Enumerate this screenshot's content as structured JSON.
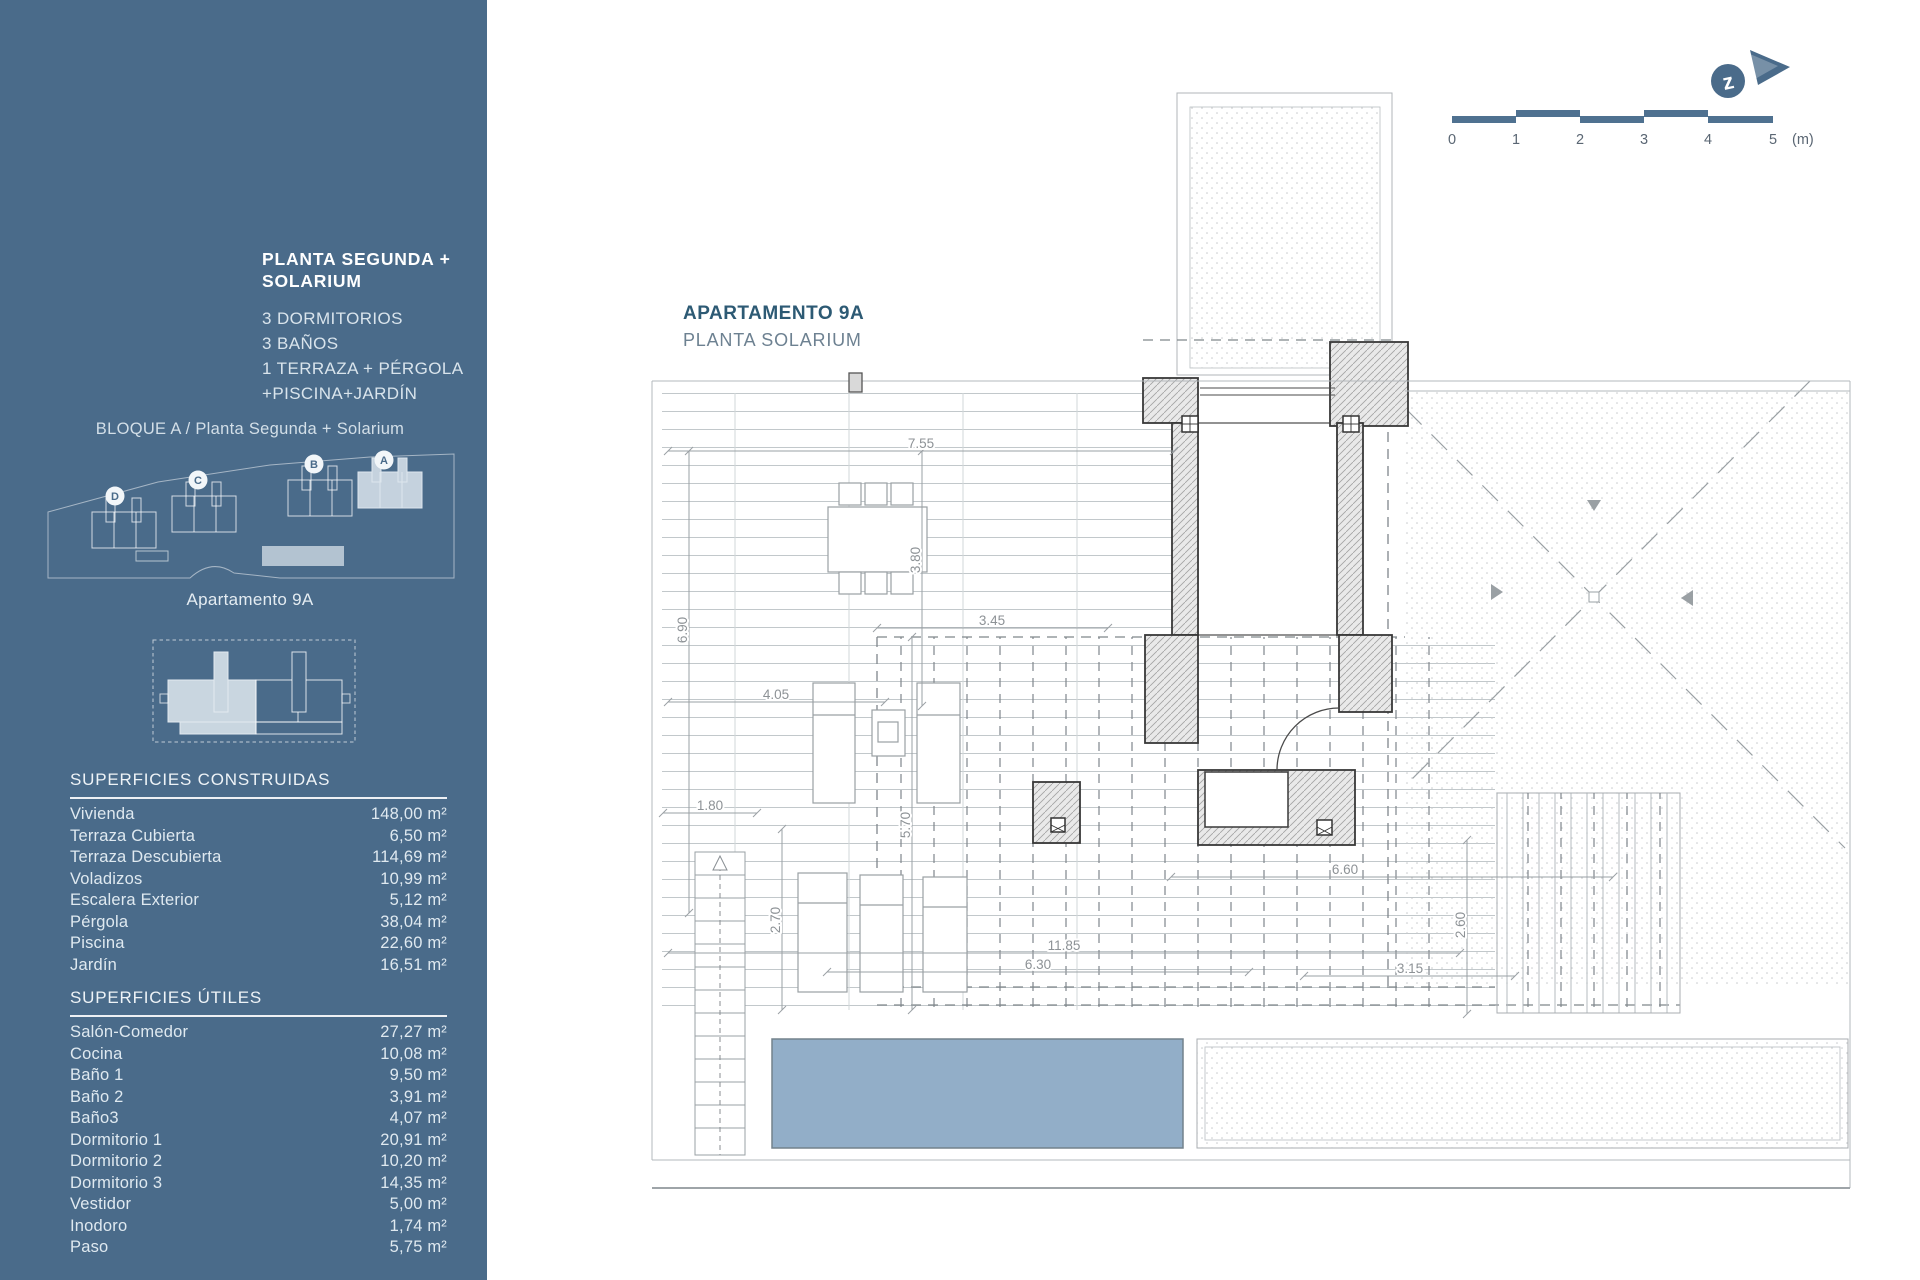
{
  "sidebar": {
    "title_lines": [
      "PLANTA SEGUNDA +",
      "SOLARIUM"
    ],
    "features": [
      "3 DORMITORIOS",
      "3 BAÑOS",
      "1 TERRAZA + PÉRGOLA",
      "+PISCINA+JARDÍN"
    ],
    "block_label": "BLOQUE A / Planta Segunda + Solarium",
    "site_badges": [
      "D",
      "C",
      "B",
      "A"
    ],
    "apartment_label": "Apartamento 9A",
    "built": {
      "title": "SUPERFICIES CONSTRUIDAS",
      "rows": [
        {
          "label": "Vivienda",
          "value": "148,00 m²"
        },
        {
          "label": "Terraza Cubierta",
          "value": "6,50 m²"
        },
        {
          "label": "Terraza Descubierta",
          "value": "114,69 m²"
        },
        {
          "label": "Voladizos",
          "value": "10,99 m²"
        },
        {
          "label": "Escalera Exterior",
          "value": "5,12 m²"
        },
        {
          "label": "Pérgola",
          "value": "38,04 m²"
        },
        {
          "label": "Piscina",
          "value": "22,60 m²"
        },
        {
          "label": "Jardín",
          "value": "16,51 m²"
        }
      ]
    },
    "useful": {
      "title": "SUPERFICIES ÚTILES",
      "rows": [
        {
          "label": "Salón-Comedor",
          "value": "27,27 m²"
        },
        {
          "label": "Cocina",
          "value": "10,08 m²"
        },
        {
          "label": "Baño 1",
          "value": "9,50 m²"
        },
        {
          "label": "Baño 2",
          "value": "3,91 m²"
        },
        {
          "label": "Baño3",
          "value": "4,07 m²"
        },
        {
          "label": "Dormitorio 1",
          "value": "20,91 m²"
        },
        {
          "label": "Dormitorio 2",
          "value": "10,20 m²"
        },
        {
          "label": "Dormitorio 3",
          "value": "14,35 m²"
        },
        {
          "label": "Vestidor",
          "value": "5,00 m²"
        },
        {
          "label": "Inodoro",
          "value": "1,74 m²"
        },
        {
          "label": "Paso",
          "value": "5,75 m²"
        }
      ]
    }
  },
  "plan": {
    "title": "APARTAMENTO 9A",
    "subtitle": "PLANTA SOLARIUM",
    "dims": [
      "7.55",
      "3.80",
      "6.90",
      "3.45",
      "4.05",
      "1.80",
      "5.70",
      "2.70",
      "6.60",
      "11.85",
      "6.30",
      "2.60",
      "3.15"
    ],
    "scale": {
      "ticks": [
        "0",
        "1",
        "2",
        "3",
        "4",
        "5"
      ],
      "unit": "(m)"
    },
    "compass_letter": "z"
  },
  "colors": {
    "sidebar_blue": "#4a6b8a",
    "highlight_block": "#c5d2de",
    "pool_blue": "#92aec8",
    "accent": "#4f7190",
    "title_dark": "#2d5a74"
  }
}
